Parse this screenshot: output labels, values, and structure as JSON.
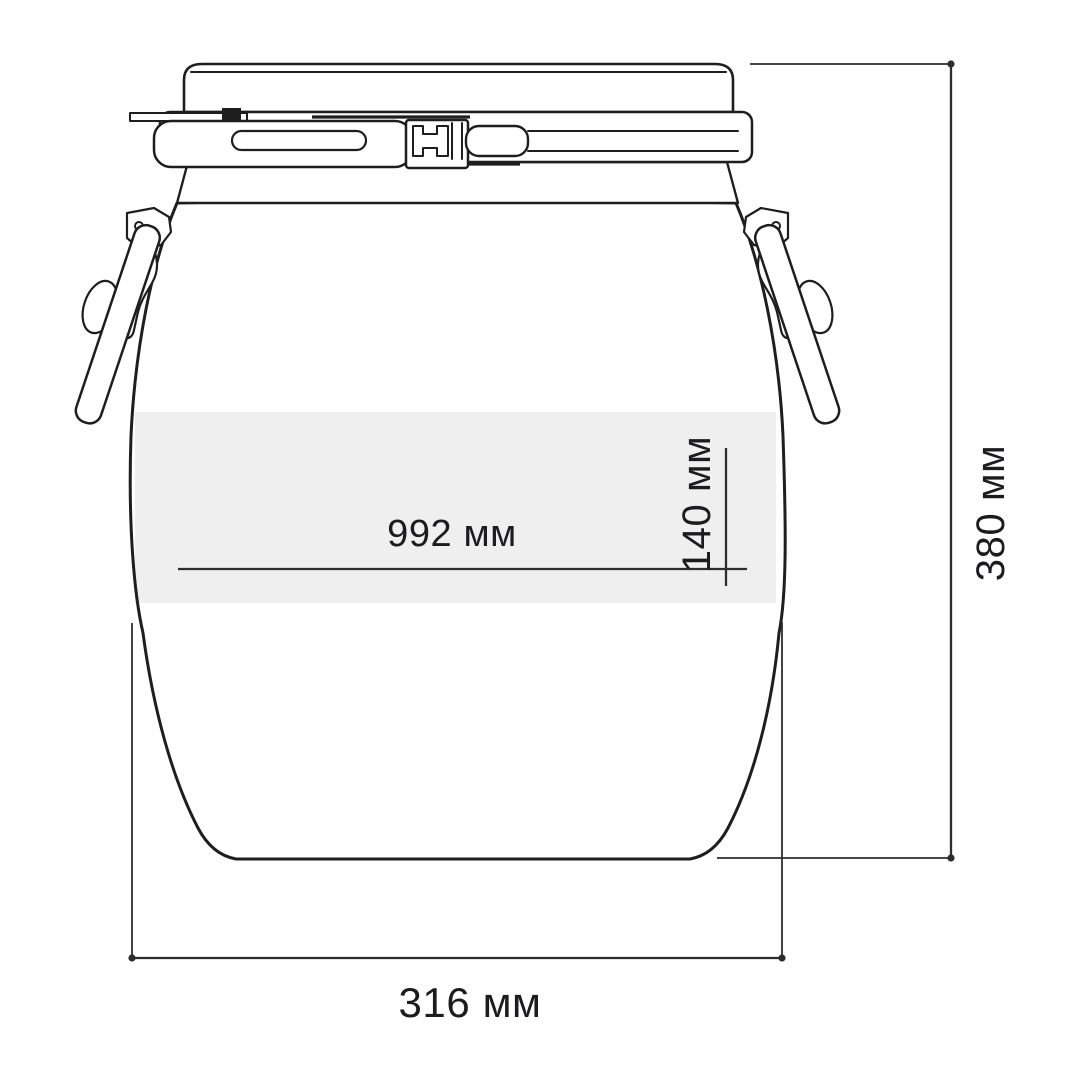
{
  "labels": {
    "girth": "992 мм",
    "inner_band": "140 мм",
    "height": "380 мм",
    "bottom_width": "316 мм"
  },
  "values": {
    "girth_mm": 992,
    "inner_band_mm": 140,
    "height_mm": 380,
    "bottom_width_mm": 316,
    "unit": "мм"
  },
  "colors": {
    "ink": "#1e1e1e",
    "dim": "#2d2d2d",
    "band": "#efefef",
    "text": "#1c1c1e",
    "background": "#ffffff"
  }
}
